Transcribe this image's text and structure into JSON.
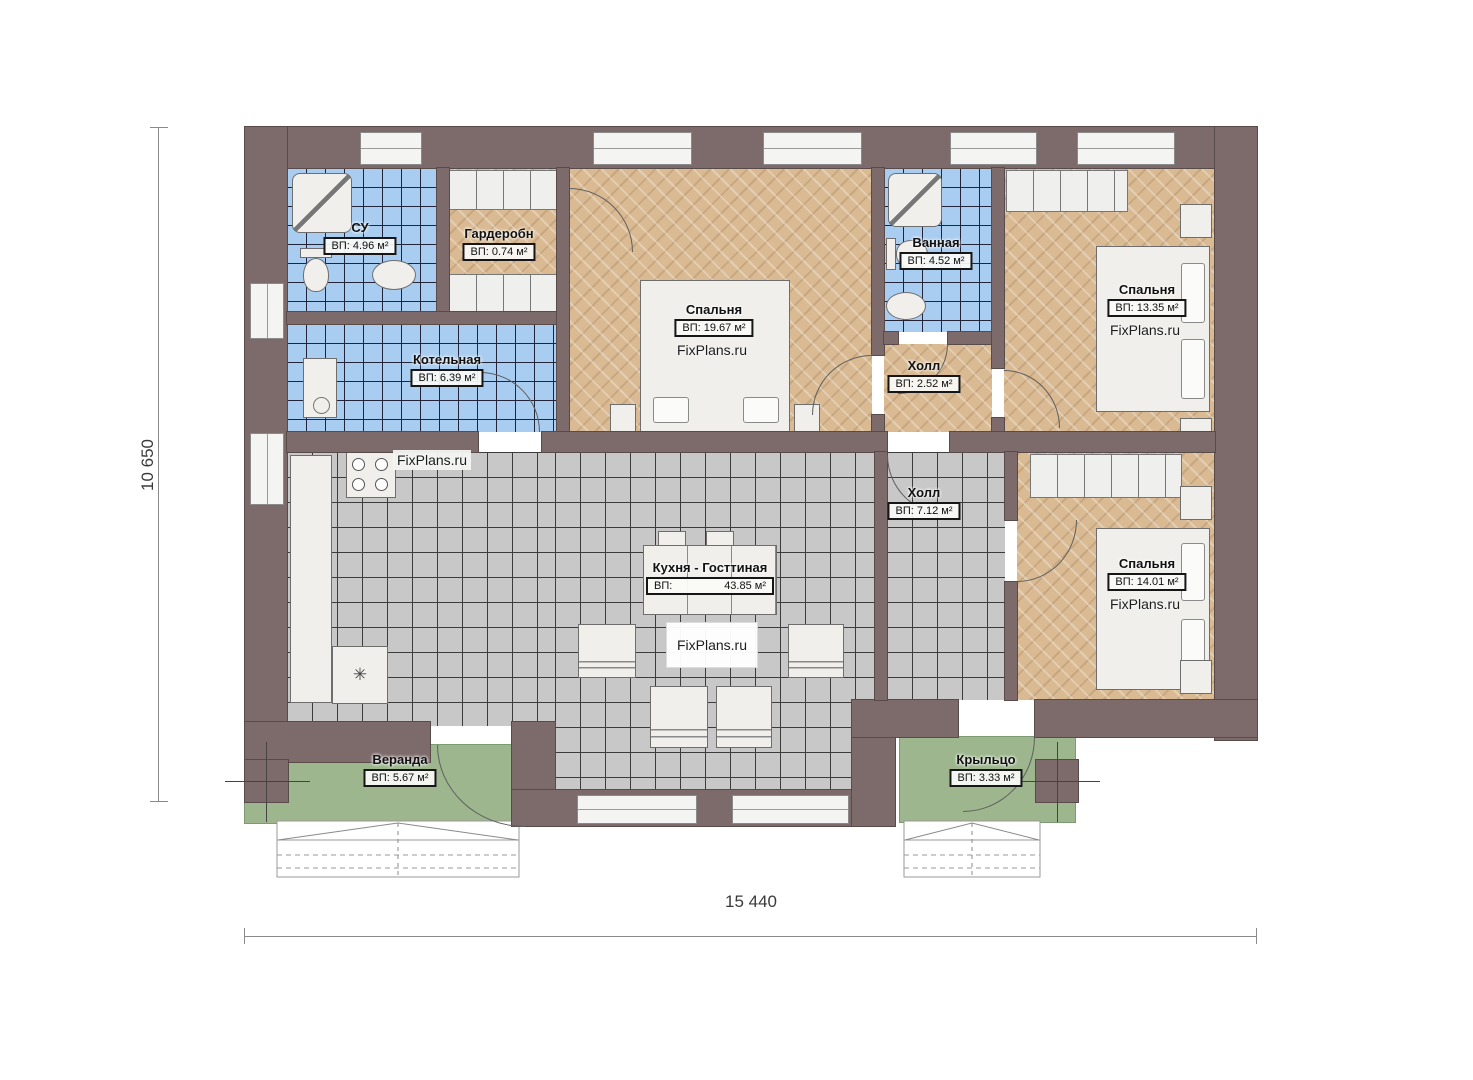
{
  "watermark": "FixPlans.ru",
  "dimensions": {
    "height": "10 650",
    "width": "15 440"
  },
  "rooms": {
    "su": {
      "name": "СУ",
      "area": "ВП: 4.96 м²"
    },
    "wardrobe": {
      "name": "Гардеробн",
      "area": "ВП: 0.74 м²"
    },
    "boiler": {
      "name": "Котельная",
      "area": "ВП: 6.39 м²"
    },
    "bedroom_top": {
      "name": "Спальня",
      "area": "ВП: 19.67 м²"
    },
    "bathroom": {
      "name": "Ванная",
      "area": "ВП: 4.52 м²"
    },
    "hall_top": {
      "name": "Холл",
      "area": "ВП: 2.52 м²"
    },
    "bedroom_right_top": {
      "name": "Спальня",
      "area": "ВП: 13.35 м²"
    },
    "kitchen_living": {
      "name": "Кухня - Госттиная",
      "area_label": "ВП:",
      "area_value": "43.85 м²"
    },
    "hall_bottom": {
      "name": "Холл",
      "area": "ВП: 7.12 м²"
    },
    "bedroom_right_bottom": {
      "name": "Спальня",
      "area": "ВП: 14.01 м²"
    },
    "veranda": {
      "name": "Веранда",
      "area": "ВП: 5.67 м²"
    },
    "porch": {
      "name": "Крыльцо",
      "area": "ВП: 3.33 м²"
    }
  },
  "colors": {
    "wall": "#7d6a6a",
    "tile_blue": "#a9cdf0",
    "tile_gray": "#c8c8c8",
    "wood": "#d9ba93",
    "grass_green": "#9db68e"
  }
}
